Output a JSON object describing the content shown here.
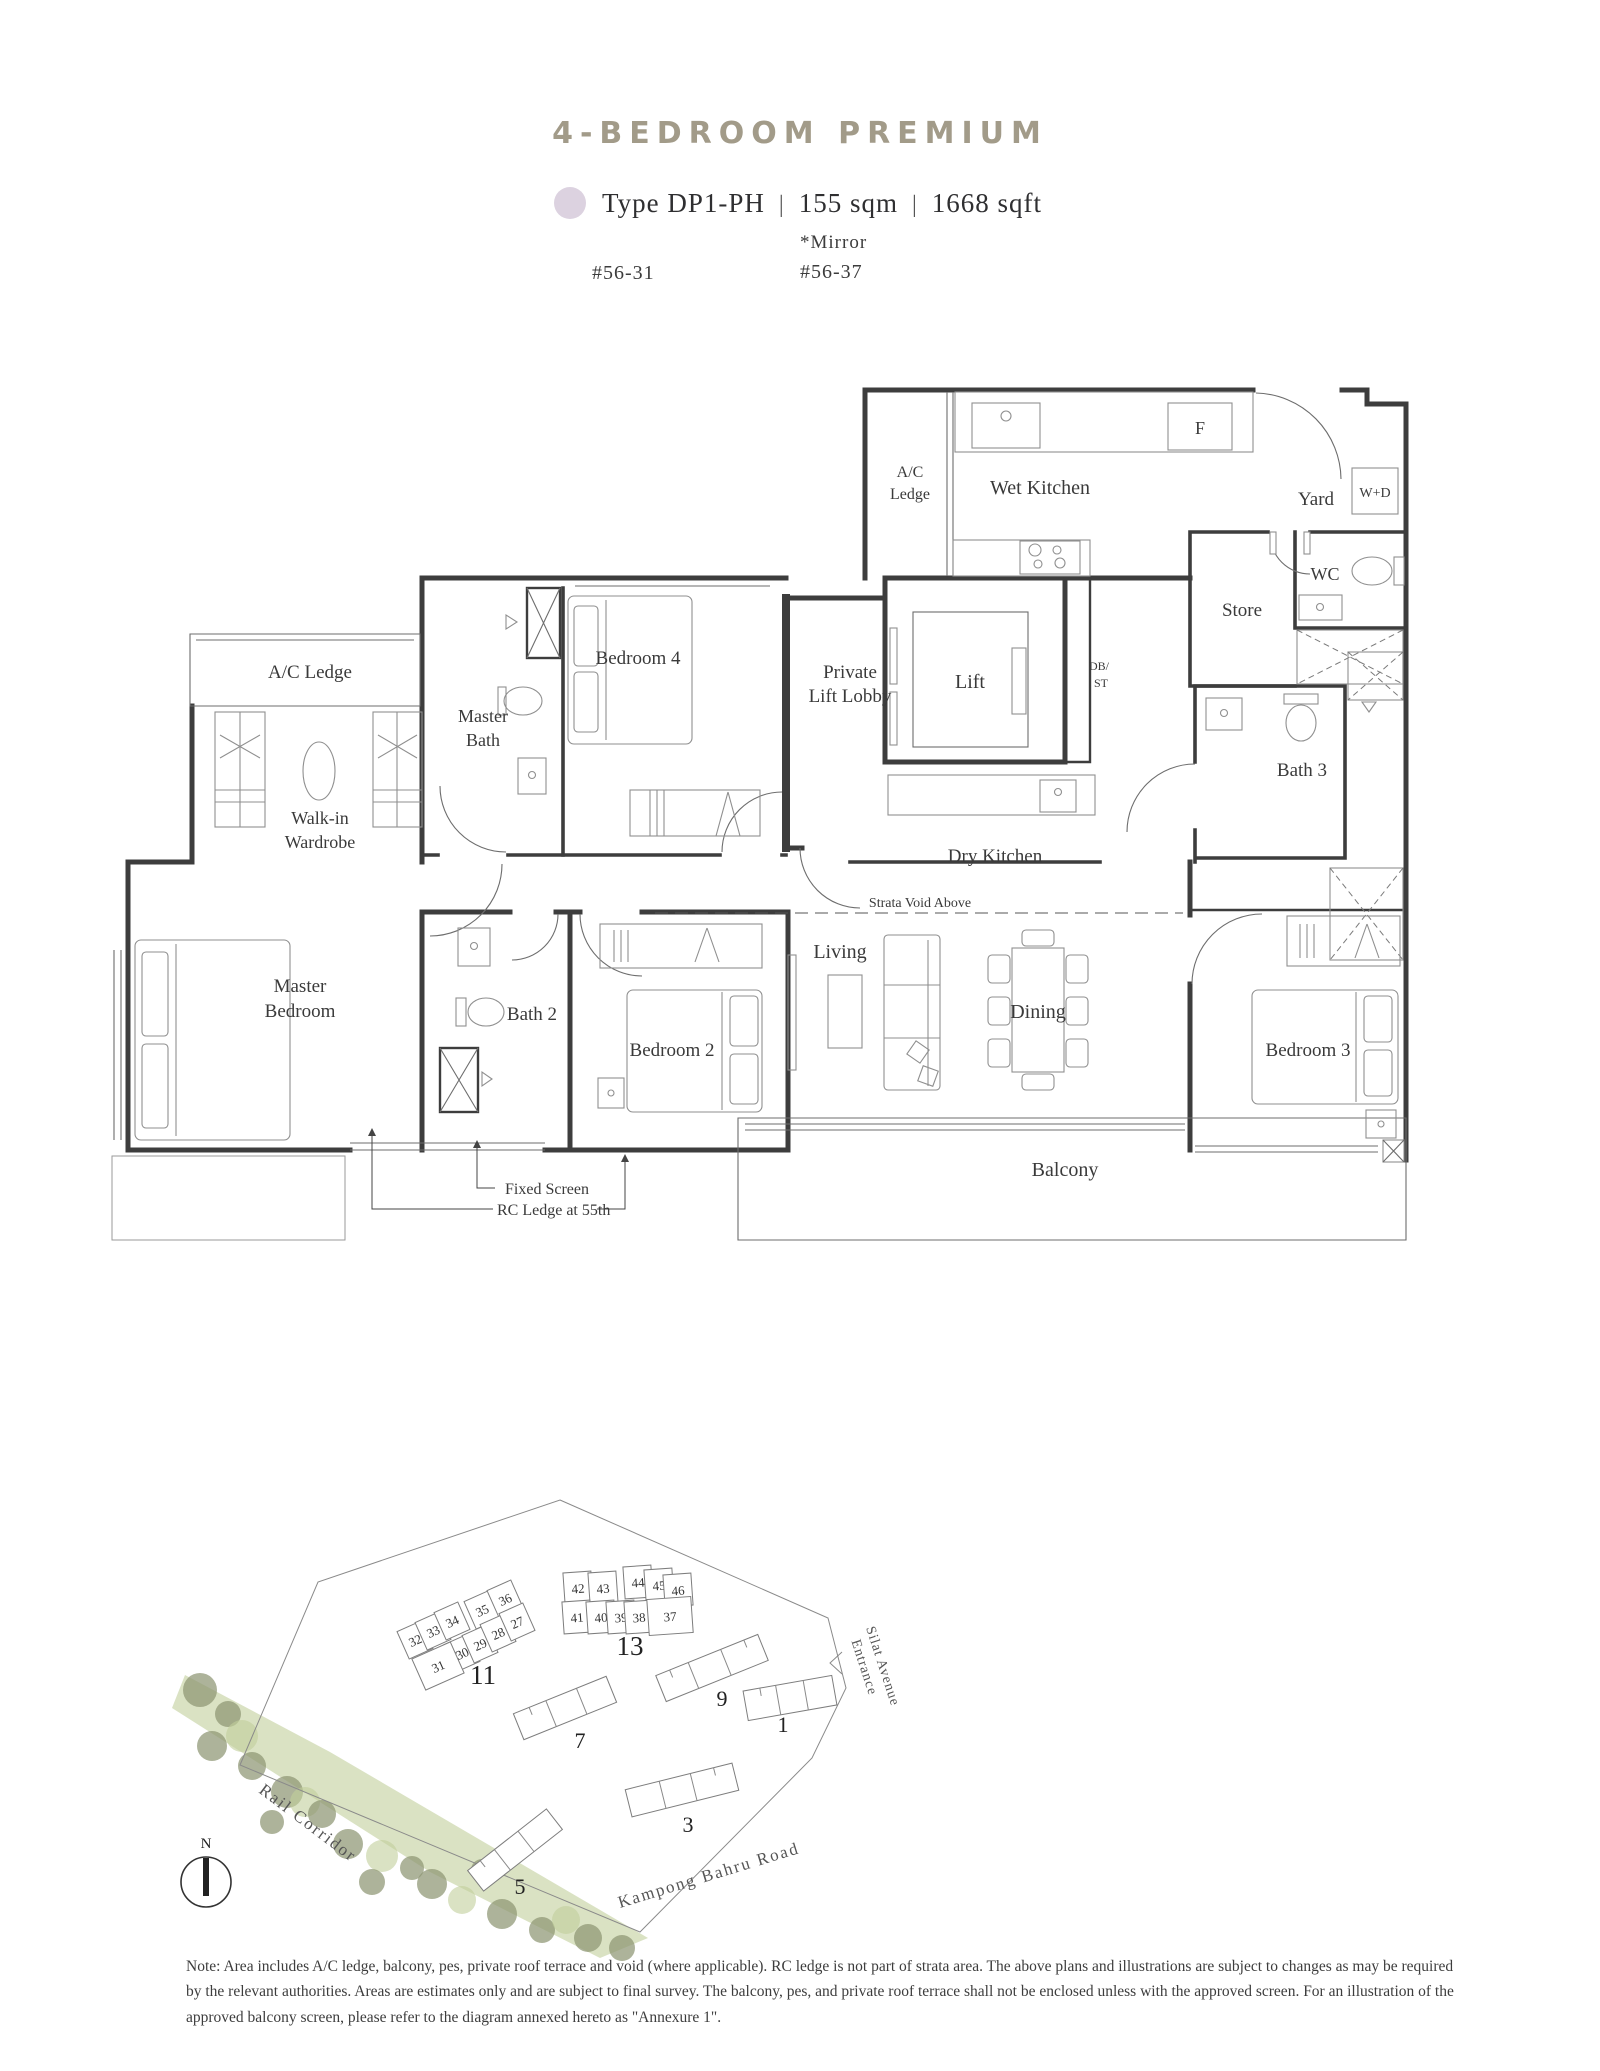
{
  "header": {
    "title": "4-BEDROOM PREMIUM",
    "title_color": "#a29b89",
    "legend": {
      "dot_color": "#dcd2e0",
      "type_label": "Type DP1-PH",
      "sep": "|",
      "area_sqm": "155 sqm",
      "area_sqft": "1668 sqft"
    },
    "units": {
      "stack_left": "#56-31",
      "mirror": "*Mirror",
      "stack_right": "#56-37"
    }
  },
  "floor_plan": {
    "labels": {
      "ac_ledge_top_1": "A/C",
      "ac_ledge_top_2": "Ledge",
      "wet_kitchen": "Wet Kitchen",
      "fridge": "F",
      "yard": "Yard",
      "washer_dryer": "W+D",
      "wc": "WC",
      "store": "Store",
      "db_1": "DB/",
      "db_2": "ST",
      "private_lift_lobby_1": "Private",
      "private_lift_lobby_2": "Lift Lobby",
      "lift": "Lift",
      "dry_kitchen": "Dry Kitchen",
      "bath_3": "Bath 3",
      "ac_ledge_left": "A/C Ledge",
      "master_bath_1": "Master",
      "master_bath_2": "Bath",
      "bedroom_4": "Bedroom 4",
      "walk_in_1": "Walk-in",
      "walk_in_2": "Wardrobe",
      "master_bedroom_1": "Master",
      "master_bedroom_2": "Bedroom",
      "bath_2": "Bath 2",
      "bedroom_2": "Bedroom 2",
      "living": "Living",
      "dining": "Dining",
      "bedroom_3": "Bedroom 3",
      "balcony": "Balcony",
      "strata_void": "Strata Void Above",
      "fixed_screen": "Fixed Screen",
      "rc_ledge": "RC Ledge at 55th"
    }
  },
  "site_plan": {
    "highlight_color": "#d4c9db",
    "block_11": {
      "label": "11",
      "stacks_top": [
        "32",
        "33",
        "34",
        "35",
        "36"
      ],
      "stacks_bottom": [
        "30",
        "29",
        "28",
        "27"
      ],
      "highlight": "31"
    },
    "block_13": {
      "label": "13",
      "stacks_top": [
        "42",
        "43",
        "44",
        "45",
        "46"
      ],
      "stacks_bottom": [
        "41",
        "40",
        "39",
        "38"
      ],
      "highlight": "37"
    },
    "buildings": {
      "b9": "9",
      "b7": "7",
      "b5": "5",
      "b3": "3",
      "b1": "1"
    },
    "roads": {
      "rail": "Rail Corridor",
      "kampong": "Kampong Bahru Road",
      "silat_1": "Silat Avenue",
      "silat_2": "Entrance"
    },
    "compass": "N"
  },
  "note": {
    "text": "Note: Area includes A/C ledge, balcony, pes, private roof terrace and void (where applicable). RC ledge is not part of strata area. The above plans and illustrations are subject to changes as may be required by the relevant authorities. Areas are estimates only and are subject to final survey. The balcony, pes, and private roof terrace shall not be enclosed unless with the approved screen. For an illustration of the approved balcony screen, please refer to the diagram annexed hereto as \"Annexure 1\"."
  }
}
